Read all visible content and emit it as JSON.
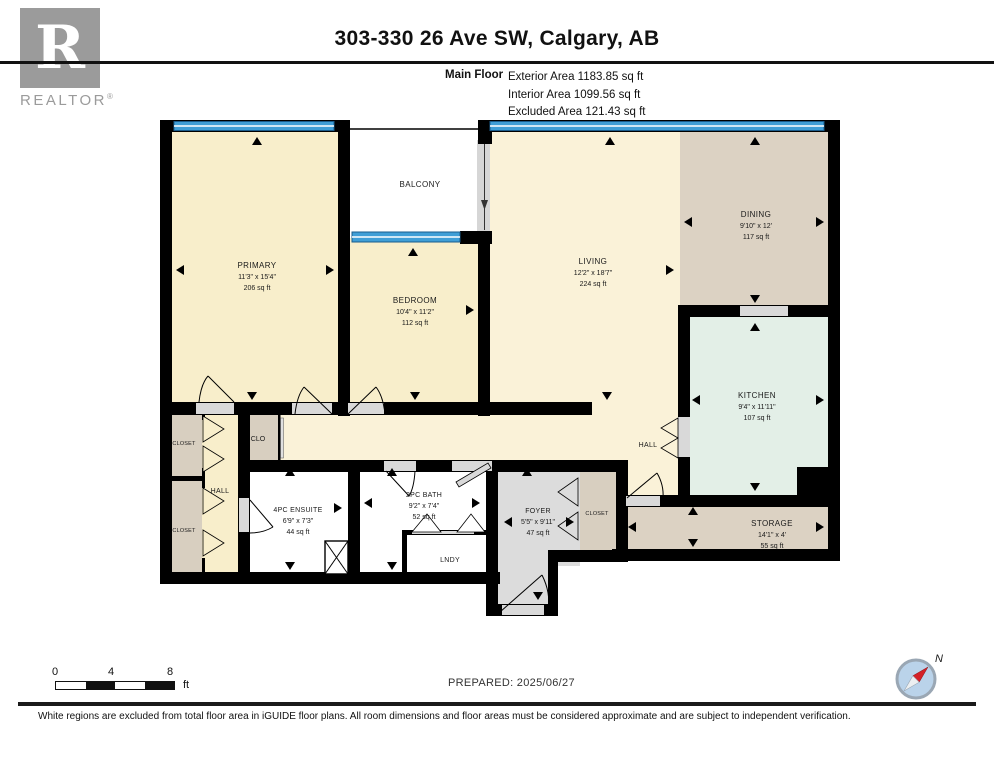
{
  "header": {
    "title": "303-330 26 Ave SW, Calgary, AB",
    "floor_label": "Main Floor",
    "areas": [
      "Exterior Area 1183.85 sq ft",
      "Interior Area 1099.56 sq ft",
      "Excluded Area 121.43 sq ft"
    ]
  },
  "logo": {
    "letter": "R",
    "label": "REALTOR",
    "reg": "®"
  },
  "rooms": {
    "primary": {
      "name": "PRIMARY",
      "dims": "11'3\" x 15'4\"",
      "area": "206 sq ft"
    },
    "balcony": {
      "name": "BALCONY"
    },
    "bedroom": {
      "name": "BEDROOM",
      "dims": "10'4\" x 11'2\"",
      "area": "112 sq ft"
    },
    "living": {
      "name": "LIVING",
      "dims": "12'2\" x 18'7\"",
      "area": "224 sq ft"
    },
    "dining": {
      "name": "DINING",
      "dims": "9'10\" x 12'",
      "area": "117 sq ft"
    },
    "kitchen": {
      "name": "KITCHEN",
      "dims": "9'4\" x 11'11\"",
      "area": "107 sq ft"
    },
    "storage": {
      "name": "STORAGE",
      "dims": "14'1\" x 4'",
      "area": "55 sq ft"
    },
    "ensuite": {
      "name": "4PC ENSUITE",
      "dims": "6'9\" x 7'3\"",
      "area": "44 sq ft"
    },
    "bath": {
      "name": "2PC BATH",
      "dims": "9'2\" x 7'4\"",
      "area": "52 sq ft"
    },
    "foyer": {
      "name": "FOYER",
      "dims": "5'5\" x 9'11\"",
      "area": "47 sq ft"
    },
    "laundry": {
      "name": "LNDY"
    },
    "hall": {
      "name": "HALL"
    },
    "clo": {
      "name": "CLO"
    },
    "closet": {
      "name": "CLOSET"
    }
  },
  "footer": {
    "scale_labels": [
      "0",
      "4",
      "8"
    ],
    "scale_unit": "ft",
    "prepared": "PREPARED: 2025/06/27",
    "compass_north": "N",
    "disclaimer": "White regions are excluded from total floor area in iGUIDE floor plans. All room dimensions and floor areas must be considered approximate and are subject to independent verification."
  },
  "colors": {
    "wall": "#000000",
    "window_blue": "#3f9ed6",
    "floor_cream": "#f8eecb",
    "floor_cream_light": "#faf2d8",
    "floor_tan": "#dcd2c3",
    "floor_mint": "#e3efe7",
    "floor_gray": "#dcdcdc",
    "logo_gray": "#9b9b9b"
  }
}
